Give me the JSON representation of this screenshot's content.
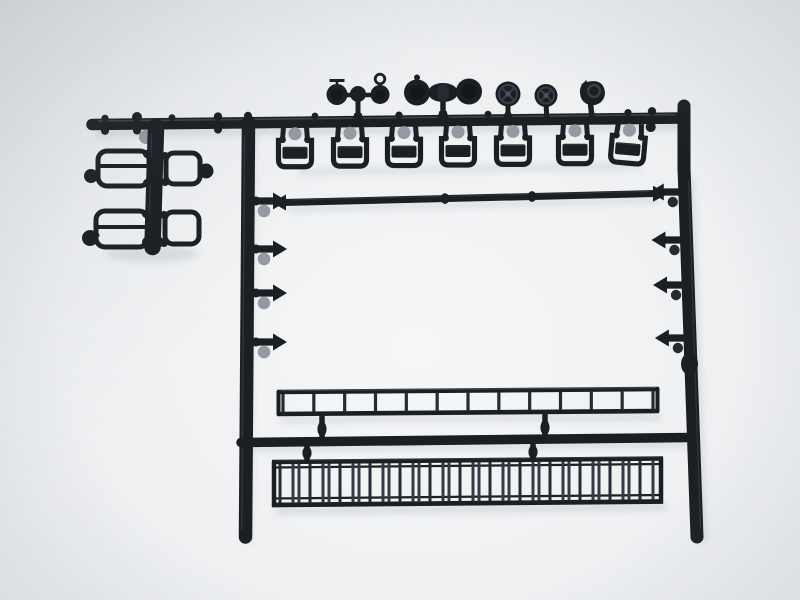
{
  "window": {
    "kind": "photograph",
    "description": "Overhead photo of a black injection-moulded model-railway detail sprue on a plain light background: a rectangular runner frame carrying a row of round lamps, seven stirrup steps, a long handrail pole with arrow-shaped sprue gates, two footboard grab irons on the left, a single 13-rung ladder and a double-rung extension ladder at the bottom."
  },
  "colors": {
    "bg-center": "#f5f6f8",
    "bg-mid": "#eef0f2",
    "bg-edge": "#e6e8eb",
    "plastic": "#1b1e23",
    "plastic-mid": "#262b33",
    "plastic-light": "#343b46",
    "highlight": "#4a5260",
    "rim": "#383f4a",
    "inner": "#14161a",
    "glint": "#5d6a5d",
    "gate-gray": "#939aa4",
    "shadow": "#5a616c"
  },
  "parts": {
    "lamp_row": {
      "count": 5,
      "items": [
        {
          "name": "twin-disc-signal-small",
          "discs": 2,
          "handles": "tee + ring"
        },
        {
          "name": "twin-disc-signal-large",
          "discs": 2
        },
        {
          "name": "spoked-round-lamp",
          "discs": 1
        },
        {
          "name": "spoked-round-lamp",
          "discs": 1
        },
        {
          "name": "angled-head-lamp",
          "discs": 1
        }
      ]
    },
    "stirrup_steps": {
      "count": 7
    },
    "handrail_pole": {
      "collars": 2
    },
    "gate_stubs": {
      "left": 4,
      "right": 4
    },
    "ladders": [
      {
        "name": "single-ladder",
        "rungs": 13
      },
      {
        "name": "extension-ladder",
        "rung_groups": 13
      }
    ],
    "footboards": {
      "count": 2
    }
  }
}
